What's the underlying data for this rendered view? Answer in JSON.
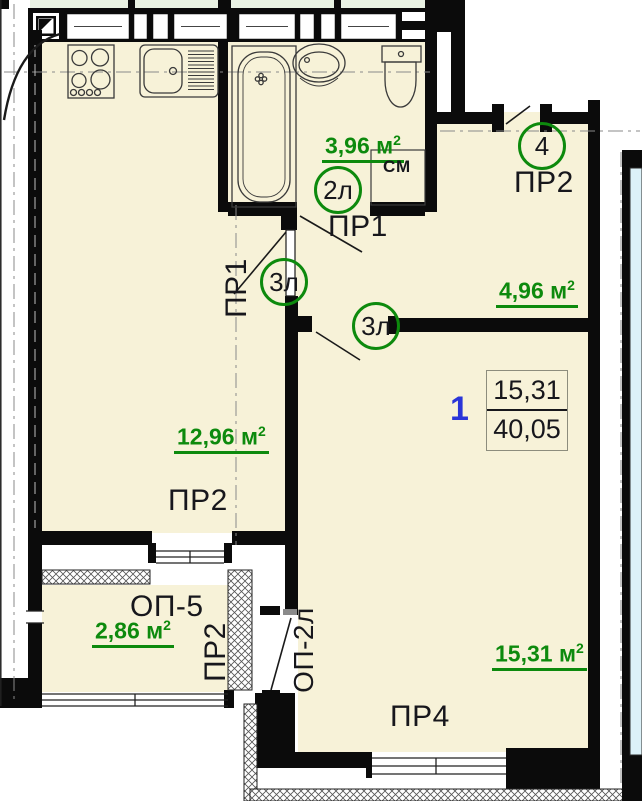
{
  "palette": {
    "room_fill": "#f7f2d8",
    "neighbor_top_fill": "#e9f2e3",
    "neighbor_right_fill": "#dcf1f8",
    "wall_color": "#0b0b0b",
    "green_accent": "#0d8a0d",
    "flat_number_blue": "#2a35d8"
  },
  "areas": {
    "unit": "м",
    "sup": "2",
    "bathroom": "3,96",
    "hall": "4,96",
    "living": "12,96",
    "balcony": "2,86",
    "main_room": "15,31"
  },
  "door_circles": {
    "bath": "2л",
    "hall_upper": "3л",
    "hall_lower": "3л",
    "entry": "4"
  },
  "room_labels": {
    "bath_door": "ПР1",
    "hall_vertical": "ПР1",
    "corridor_top": "ПР2",
    "living": "ПР2",
    "balcony_vertical": "ПР2",
    "main_room": "ПР4",
    "balcony_window": "ОП-5",
    "balcony_door": "ОП-2л",
    "washing_machine": "СМ"
  },
  "flat": {
    "number": "1",
    "area_living": "15,31",
    "area_total": "40,05"
  }
}
